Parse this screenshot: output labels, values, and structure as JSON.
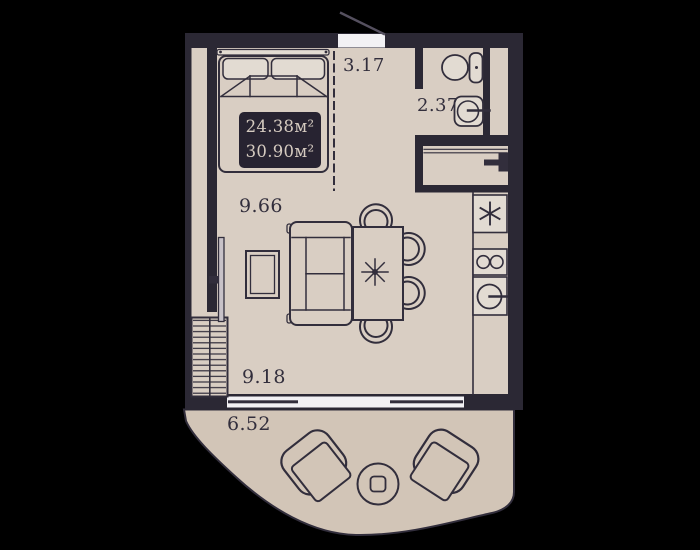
{
  "plan_labels": {
    "area_box_line1": "24.38м²",
    "area_box_line2": "30.90м²",
    "hallway_area": "3.17",
    "bathroom_area": "2.37",
    "living_area": "9.66",
    "kitchen_zone_area": "9.18",
    "balcony_area": "6.52"
  },
  "icons": {
    "fridge": "six-spoke-asterisk",
    "cooktop": "two-burner-circles",
    "kitchen_sink": "circle-with-faucet-line",
    "bathroom_sink": "circle-in-rounded-square-with-faucet",
    "toilet": "bowl-ellipse-with-tank",
    "table_plant": "eight-point-star-leaf"
  },
  "colors": {
    "background": "#000000",
    "wall": "#2b2834",
    "ink": "#322e3c",
    "floor": "#d9cec3",
    "balcony": "#d2c5b7",
    "window": "#f2f1f4",
    "light": "#e2dbd2",
    "boxbg": "#272331",
    "boxtext": "#d5cbc0",
    "tv": "#c8c2c8",
    "doorline": "#55505f"
  }
}
